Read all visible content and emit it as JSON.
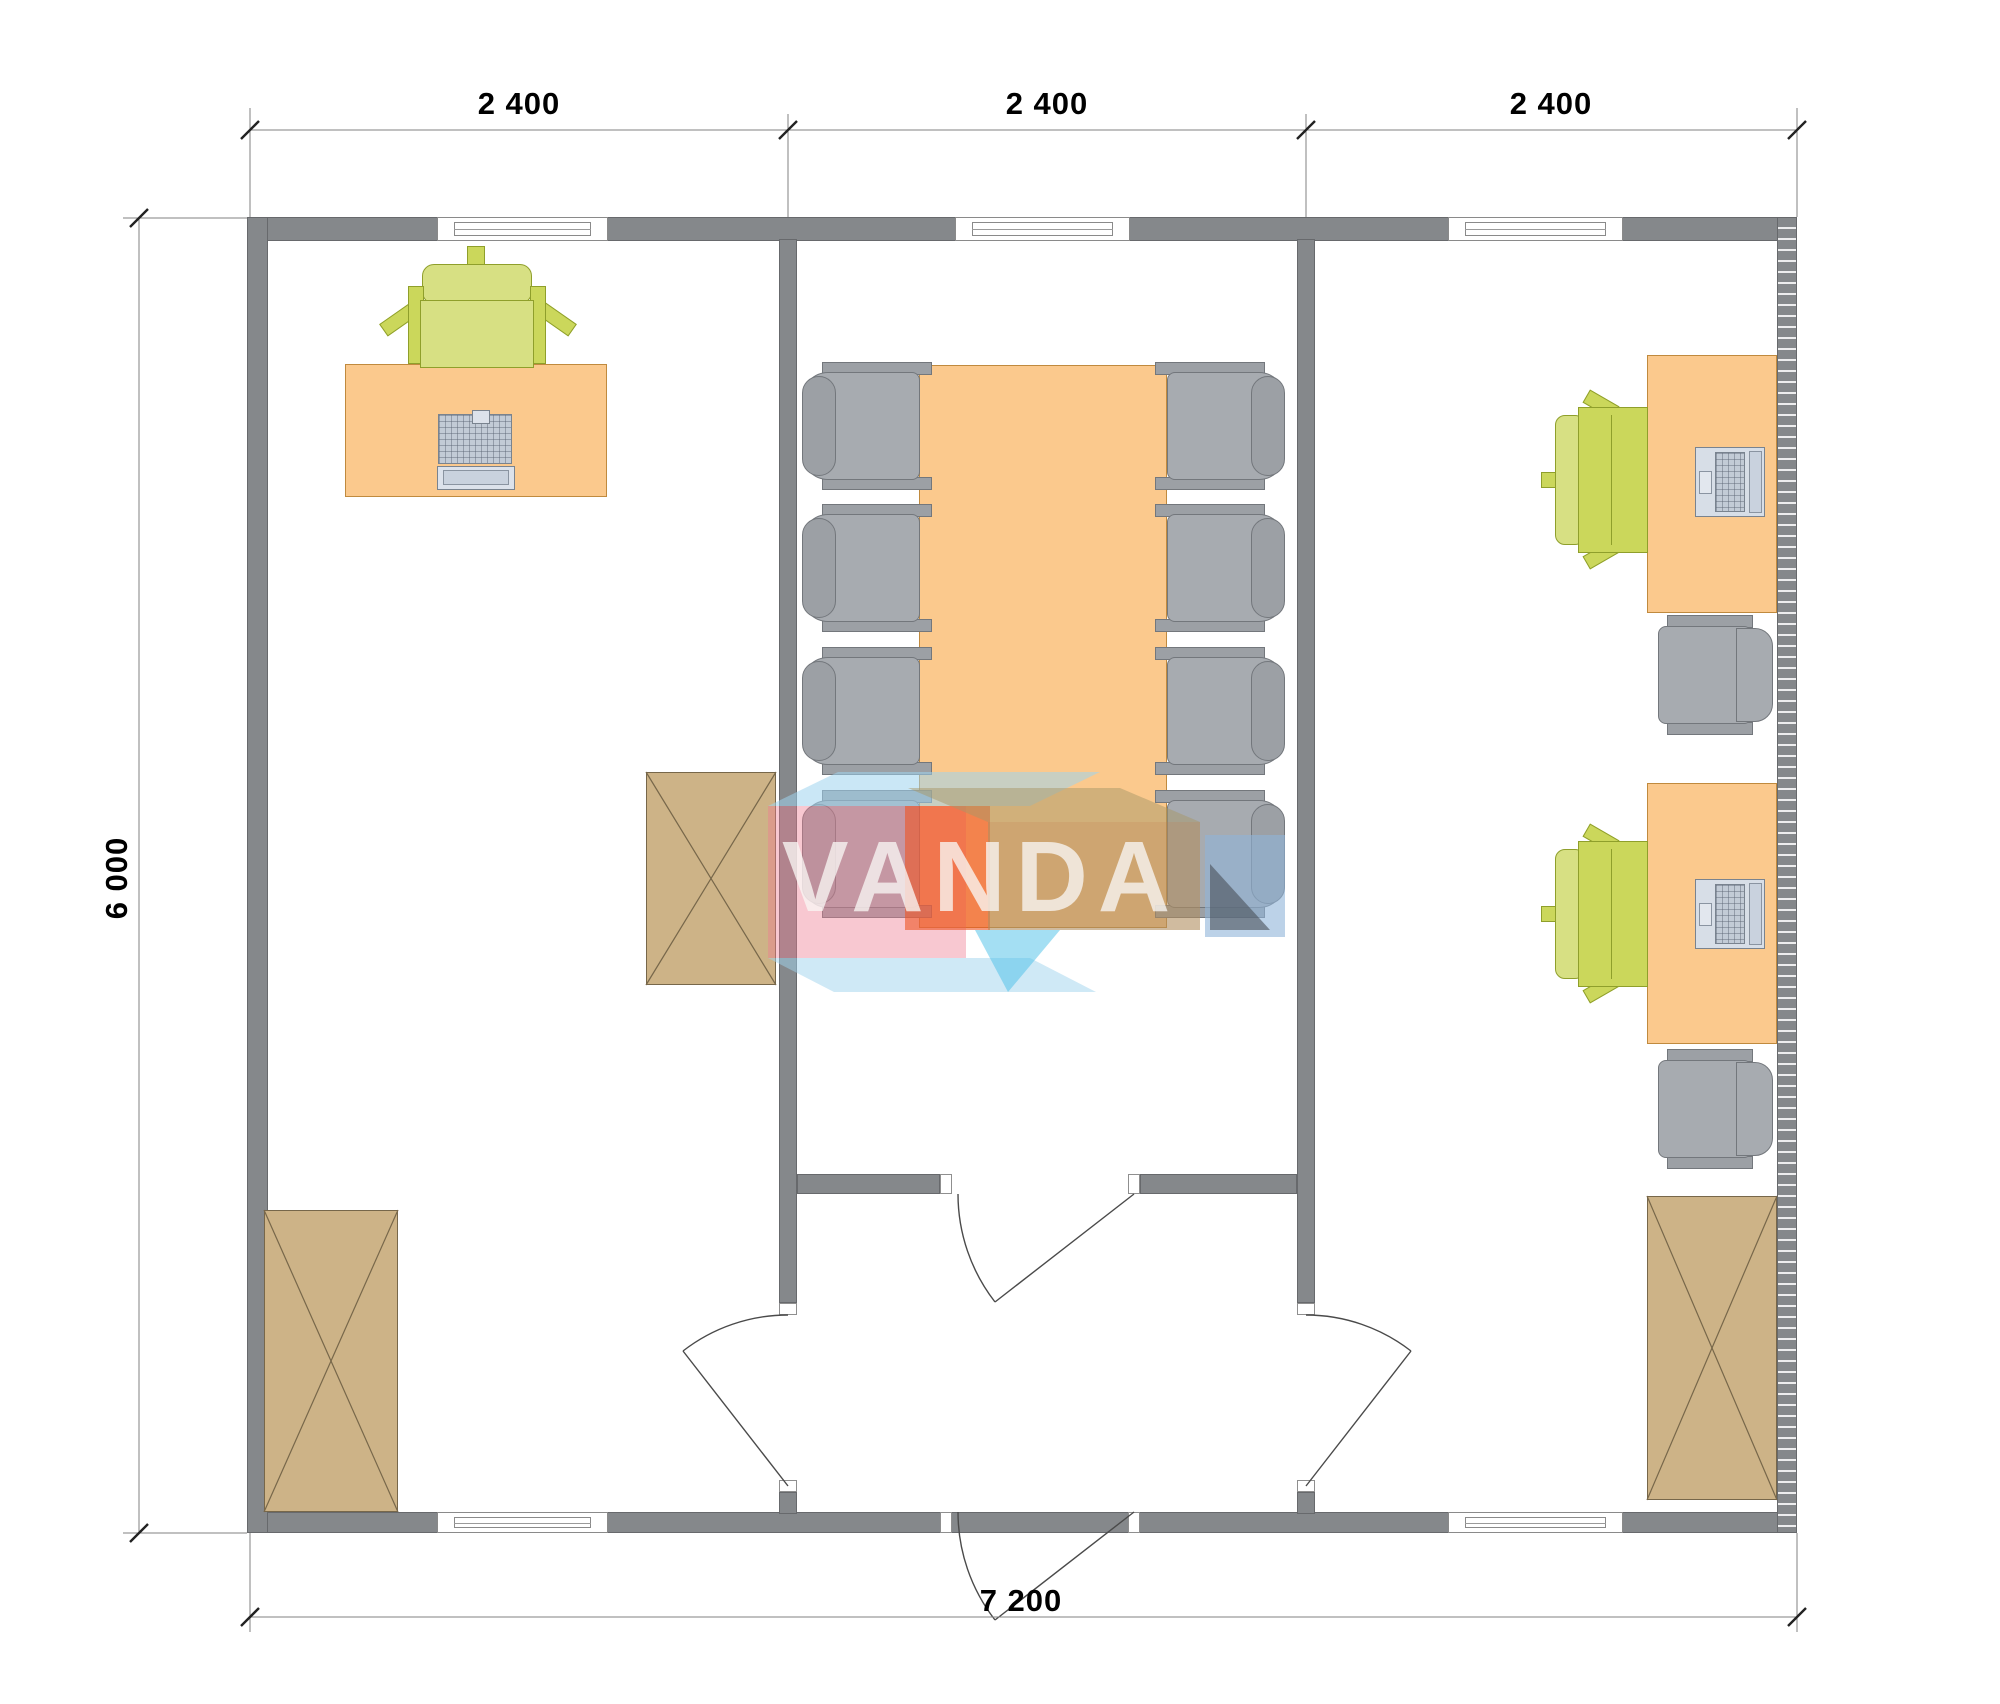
{
  "drawing": {
    "type": "floor-plan",
    "watermark": "VANDA",
    "dimension_labels": {
      "top": [
        "2 400",
        "2 400",
        "2 400"
      ],
      "left": "6 000",
      "bottom": "7 200"
    },
    "rooms": {
      "left_office": [
        "desk",
        "office-chair",
        "computer",
        "cabinet",
        "cabinet"
      ],
      "meeting_room": [
        "conference-table",
        "chair-x8",
        "entrance-door",
        "inner-door"
      ],
      "right_office": [
        "desk-x2",
        "laptop-x2",
        "office-chair-x2",
        "side-chair-x2",
        "cabinet"
      ]
    }
  },
  "palette": {
    "wall": "#85888B",
    "desk": "#FBC98D",
    "desk_border": "#C08A3E",
    "chair_green": "#CBD75B",
    "chair_green_border": "#8F9F2B",
    "chair_gray": "#A7ABB0",
    "chair_gray_border": "#73777C",
    "cabinet": "#CDB387",
    "cabinet_border": "#77674A",
    "logo_pink": "#EE7D92",
    "logo_orange": "#EE5523",
    "logo_blue": "#9FD4EE",
    "logo_tan": "#B08E5F",
    "dimension_text": "#000000"
  }
}
